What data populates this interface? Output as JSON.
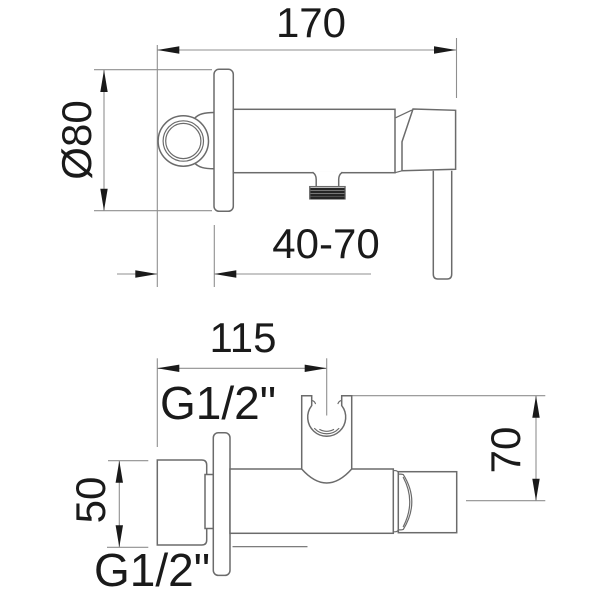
{
  "drawing": {
    "palette": {
      "background": "#ffffff",
      "outline": "#6b6b6b",
      "dimension_lines": "#8f8f8f",
      "text": "#1a1a1a",
      "thread_hatch": "#262626"
    },
    "side_view": {
      "total_depth": "170",
      "plate_diameter": "Ø80",
      "install_depth_range": "40-70"
    },
    "plan_view": {
      "holder_distance": "115",
      "outlet_thread": "G1/2\"",
      "holder_height": "70",
      "inlet_height": "50",
      "inlet_thread": "G1/2\""
    }
  }
}
